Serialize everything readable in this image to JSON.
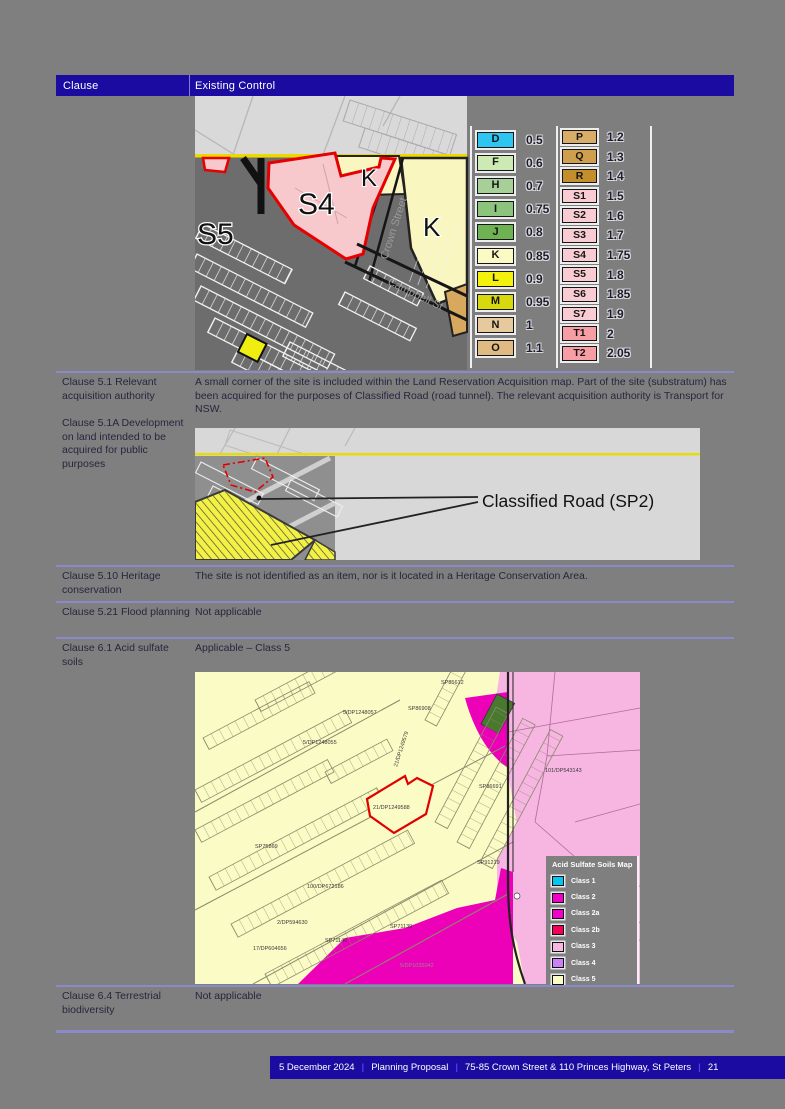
{
  "header": {
    "clause": "Clause",
    "existing_control": "Existing Control"
  },
  "rows": {
    "acquisition": {
      "clause_a": "Clause 5.1 Relevant acquisition authority",
      "clause_b": "Clause 5.1A Development on land intended to be acquired for public purposes",
      "control": "A small corner of the site is included within the Land Reservation Acquisition map. Part of the site (substratum) has been acquired for the purposes of Classified Road (road tunnel). The relevant acquisition authority is Transport for NSW."
    },
    "heritage": {
      "clause": "Clause 5.10 Heritage conservation",
      "control": "The site is not identified as an item, nor is it located in a Heritage Conservation Area."
    },
    "flood": {
      "clause": "Clause 5.21 Flood planning",
      "control": "Not applicable"
    },
    "acid": {
      "clause": "Clause 6.1 Acid sulfate soils",
      "control": "Applicable – Class 5"
    },
    "biodiversity": {
      "clause": "Clause 6.4 Terrestrial biodiversity",
      "control": "Not applicable"
    }
  },
  "fsr_map": {
    "zones": {
      "s5": "S5",
      "s4": "S4",
      "k_small": "K",
      "k_big": "K"
    },
    "streets": {
      "crown": "Crown Street",
      "campbell": "Campbell St"
    },
    "legend_col1": [
      {
        "label": "D",
        "value": "0.5",
        "color": "#2ec6f0"
      },
      {
        "label": "F",
        "value": "0.6",
        "color": "#cde9b4"
      },
      {
        "label": "H",
        "value": "0.7",
        "color": "#a6d097"
      },
      {
        "label": "I",
        "value": "0.75",
        "color": "#8cc47e"
      },
      {
        "label": "J",
        "value": "0.8",
        "color": "#6fb254"
      },
      {
        "label": "K",
        "value": "0.85",
        "color": "#fbf9c4"
      },
      {
        "label": "L",
        "value": "0.9",
        "color": "#f2f20c"
      },
      {
        "label": "M",
        "value": "0.95",
        "color": "#d8d80e"
      },
      {
        "label": "N",
        "value": "1",
        "color": "#e6c99c"
      },
      {
        "label": "O",
        "value": "1.1",
        "color": "#dfba83"
      }
    ],
    "legend_col2": [
      {
        "label": "P",
        "value": "1.2",
        "color": "#d8ad67"
      },
      {
        "label": "Q",
        "value": "1.3",
        "color": "#cf9f4e"
      },
      {
        "label": "R",
        "value": "1.4",
        "color": "#c38e2c"
      },
      {
        "label": "S1",
        "value": "1.5",
        "color": "#f9ccd3"
      },
      {
        "label": "S2",
        "value": "1.6",
        "color": "#f9ccd3"
      },
      {
        "label": "S3",
        "value": "1.7",
        "color": "#f9ccd3"
      },
      {
        "label": "S4",
        "value": "1.75",
        "color": "#f9ccd3"
      },
      {
        "label": "S5",
        "value": "1.8",
        "color": "#f9ccd3"
      },
      {
        "label": "S6",
        "value": "1.85",
        "color": "#f9ccd3"
      },
      {
        "label": "S7",
        "value": "1.9",
        "color": "#f9ccd3"
      },
      {
        "label": "T1",
        "value": "2",
        "color": "#f79da4"
      },
      {
        "label": "T2",
        "value": "2.05",
        "color": "#f79da4"
      }
    ]
  },
  "lra_map": {
    "callout": "Classified Road (SP2)"
  },
  "ass_map": {
    "site_label": "21/DP1249588",
    "lots": [
      "SP85612",
      "SP86908",
      "5/DP1248057",
      "5/DP1248055",
      "21/DP1249579",
      "101/DP543143",
      "SP86691",
      "SP91219",
      "SP75869",
      "100/DP672186",
      "2/DP594630",
      "17/DP604656",
      "SP71139",
      "SP71140",
      "5/DP1035042"
    ],
    "legend": {
      "title": "Acid Sulfate Soils Map",
      "entries": [
        {
          "label": "Class 1",
          "color": "#00c8f0"
        },
        {
          "label": "Class 2",
          "color": "#f000c8"
        },
        {
          "label": "Class 2a",
          "color": "#f000c8"
        },
        {
          "label": "Class 2b",
          "color": "#f2005a"
        },
        {
          "label": "Class 3",
          "color": "#f8b7e3"
        },
        {
          "label": "Class 4",
          "color": "#cc80f5"
        },
        {
          "label": "Class 5",
          "color": "#fbfbc4"
        }
      ]
    }
  },
  "footer": {
    "date": "5 December 2024",
    "doc": "Planning Proposal",
    "address": "75-85 Crown Street & 110 Princes Highway, St Peters",
    "page_number": "21",
    "separator": "|"
  }
}
